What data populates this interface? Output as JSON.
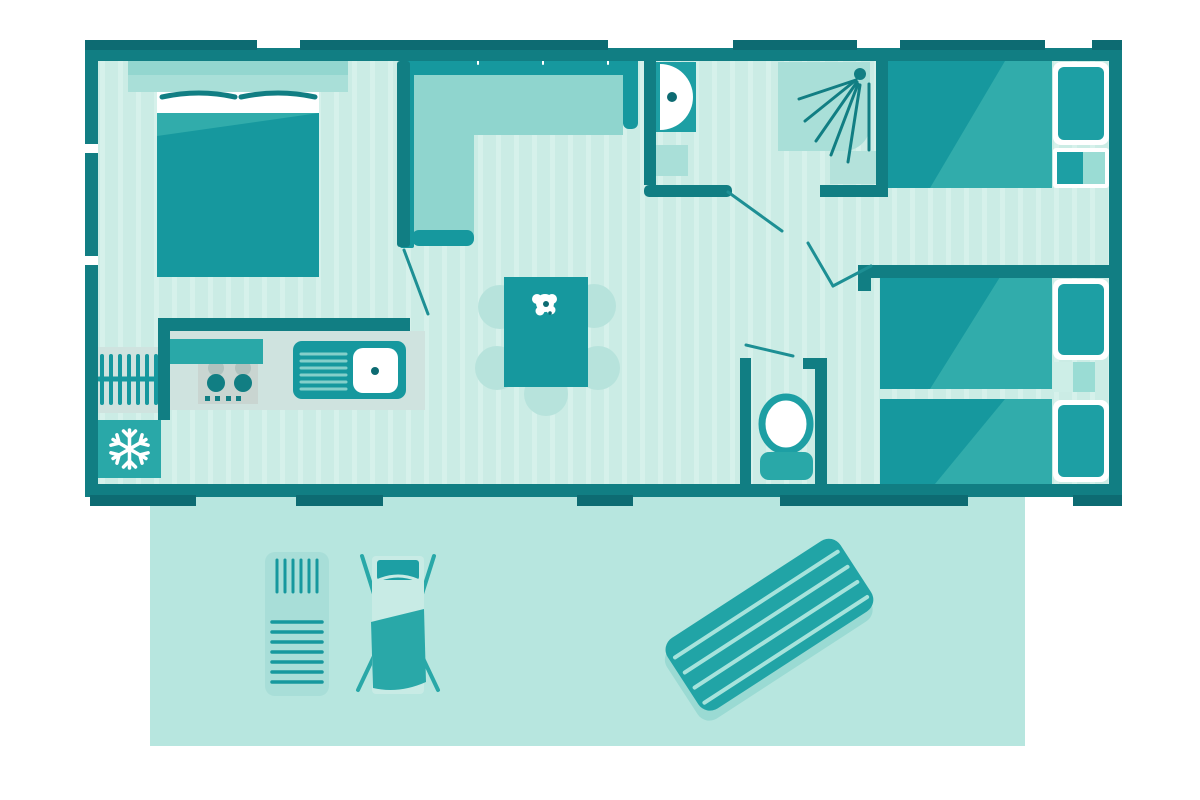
{
  "title": "mobile-home-floor-plan",
  "palette": {
    "wall": "#117e83",
    "tab": "#0d6b72",
    "floor": "#cbece5",
    "floor_stripe": "#d6f1eb",
    "terrace": "#b7e6df",
    "dark": "#16989e",
    "med": "#29a8a8",
    "wedge": "#31acab",
    "seat": "#8fd5ce",
    "accent": "#a9dfd8",
    "chair": "#b7e3dc",
    "counter": "#cfe3df",
    "stove": "#c9d5d1",
    "pillow": "#1d9fa4",
    "door_line": "#1d8f94",
    "light_box": "#9adcd4",
    "deck": "#c8ebe5",
    "lounger": "#a8ded8",
    "mattress": "#21a4a6",
    "mattress_stripe": "#a6e3dc",
    "mattress_shadow": "#9adad3",
    "drain": "#84cfca",
    "ghost": "#b0c2be",
    "white": "#ffffff"
  },
  "plan": {
    "rooms": [
      {
        "name": "master-bedroom",
        "furniture": [
          "double-bed",
          "pillows",
          "headboard-shelf"
        ]
      },
      {
        "name": "kitchen",
        "furniture": [
          "radiator",
          "fridge-freezer-snowflake",
          "stove-burners",
          "sink-with-drainboard",
          "counter"
        ]
      },
      {
        "name": "living-area",
        "furniture": [
          "l-shaped-sofa",
          "dining-table",
          "five-chairs",
          "table-flower"
        ]
      },
      {
        "name": "bathroom",
        "furniture": [
          "washbasin",
          "shelf",
          "shower-tray",
          "shower-spray"
        ]
      },
      {
        "name": "wc",
        "furniture": [
          "toilet"
        ]
      },
      {
        "name": "bedroom-right-top",
        "furniture": [
          "single-bed",
          "pillow",
          "nightstand"
        ]
      },
      {
        "name": "bedroom-right-bottom",
        "furniture": [
          "single-bed",
          "single-bed",
          "pillow",
          "pillow",
          "nightstand"
        ]
      }
    ],
    "terrace": {
      "name": "terrace",
      "furniture": [
        "sun-lounger",
        "deck-chair",
        "air-mattress"
      ]
    },
    "counts": {
      "chairs": 5,
      "single_beds": 3,
      "double_beds": 1,
      "door_swings": 5
    }
  }
}
